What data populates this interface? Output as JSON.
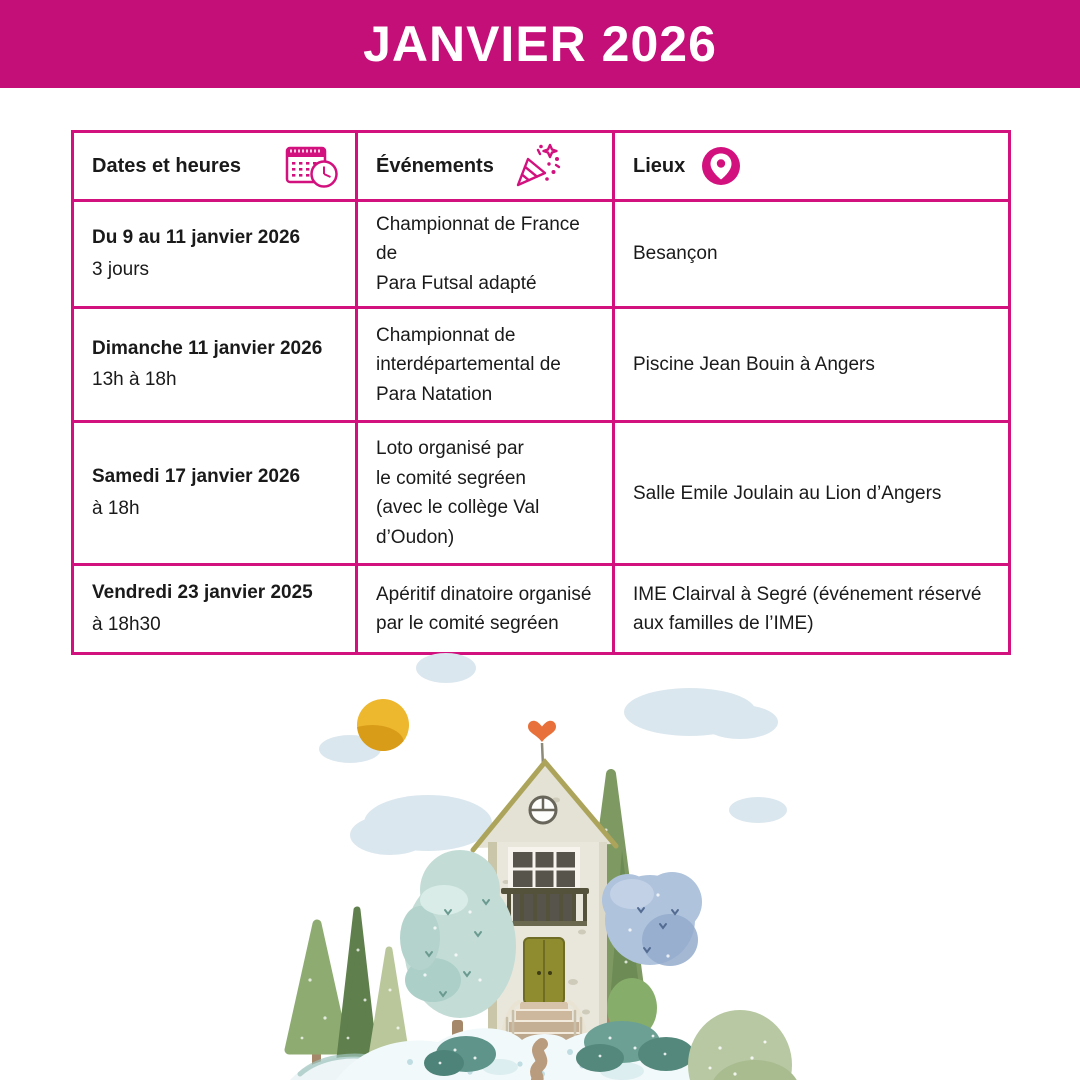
{
  "banner": {
    "title": "JANVIER 2026",
    "bg_color": "#C40E78",
    "text_color": "#FFFFFF"
  },
  "table": {
    "border_color": "#D2107E",
    "headers": [
      {
        "label": "Dates et heures",
        "icon": "calendar-clock-icon"
      },
      {
        "label": "Événements",
        "icon": "party-popper-icon"
      },
      {
        "label": "Lieux",
        "icon": "location-pin-icon"
      }
    ],
    "rows": [
      {
        "date": "Du 9 au 11 janvier 2026",
        "time": "3 jours",
        "event": "Championnat de France de\nPara Futsal adapté",
        "place": "Besançon"
      },
      {
        "date": "Dimanche 11 janvier 2026",
        "time": "13h à 18h",
        "event": "Championnat de\ninterdépartemental de\nPara Natation",
        "place": "Piscine Jean Bouin à Angers"
      },
      {
        "date": "Samedi 17 janvier 2026",
        "time": "à 18h",
        "event": "Loto organisé par\nle comité segréen\n(avec le collège Val\nd’Oudon)",
        "place": "Salle Emile Joulain au Lion d’Angers"
      },
      {
        "date": "Vendredi 23 janvier 2025",
        "time": "à 18h30",
        "event": "Apéritif dinatoire organisé\npar le comité segréen",
        "place": "IME Clairval à Segré (événement réservé\naux familles de l’IME)"
      }
    ]
  },
  "illustration": {
    "description": "watercolor house on a snowy hill with pine trees, round trees, bushes, sun and clouds",
    "colors": {
      "sun": "#EDB72E",
      "cloud": "#DBE7EE",
      "house_wall": "#E9E7DB",
      "roof_trim": "#ADA45C",
      "door": "#8F8C30",
      "heart": "#E8713B",
      "mint_tree": "#C3DCD6",
      "blue_tree": "#AFC3DC",
      "pine_green": "#8EAB71",
      "hill": "#F2F9FA",
      "path": "#B99C7E"
    }
  }
}
